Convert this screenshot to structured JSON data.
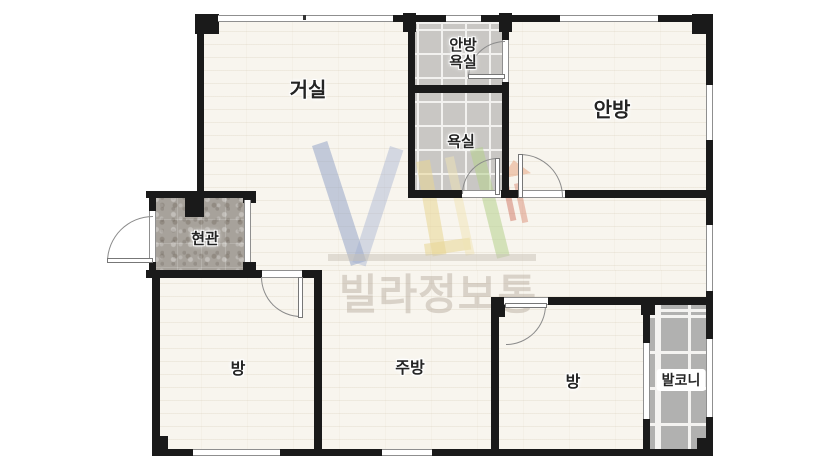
{
  "watermark": {
    "brand_text": "빌라정보통"
  },
  "rooms": {
    "living": {
      "label": "거실"
    },
    "master_bathroom": {
      "label": "안방\n욕실"
    },
    "bathroom": {
      "label": "욕실"
    },
    "master_bedroom": {
      "label": "안방"
    },
    "entrance": {
      "label": "현관"
    },
    "bedroom_left": {
      "label": "방"
    },
    "kitchen": {
      "label": "주방"
    },
    "bedroom_right": {
      "label": "방"
    },
    "balcony": {
      "label": "발코니"
    }
  },
  "colors": {
    "wall": "#1a1a1a",
    "floor": "#f8f5ee",
    "bath_tile": "#c9c7c4",
    "balcony_tile": "#b1b1b0",
    "entrance_floor": "#a7a29b",
    "door_stroke": "#8a8a8a",
    "label_text": "#242424"
  }
}
